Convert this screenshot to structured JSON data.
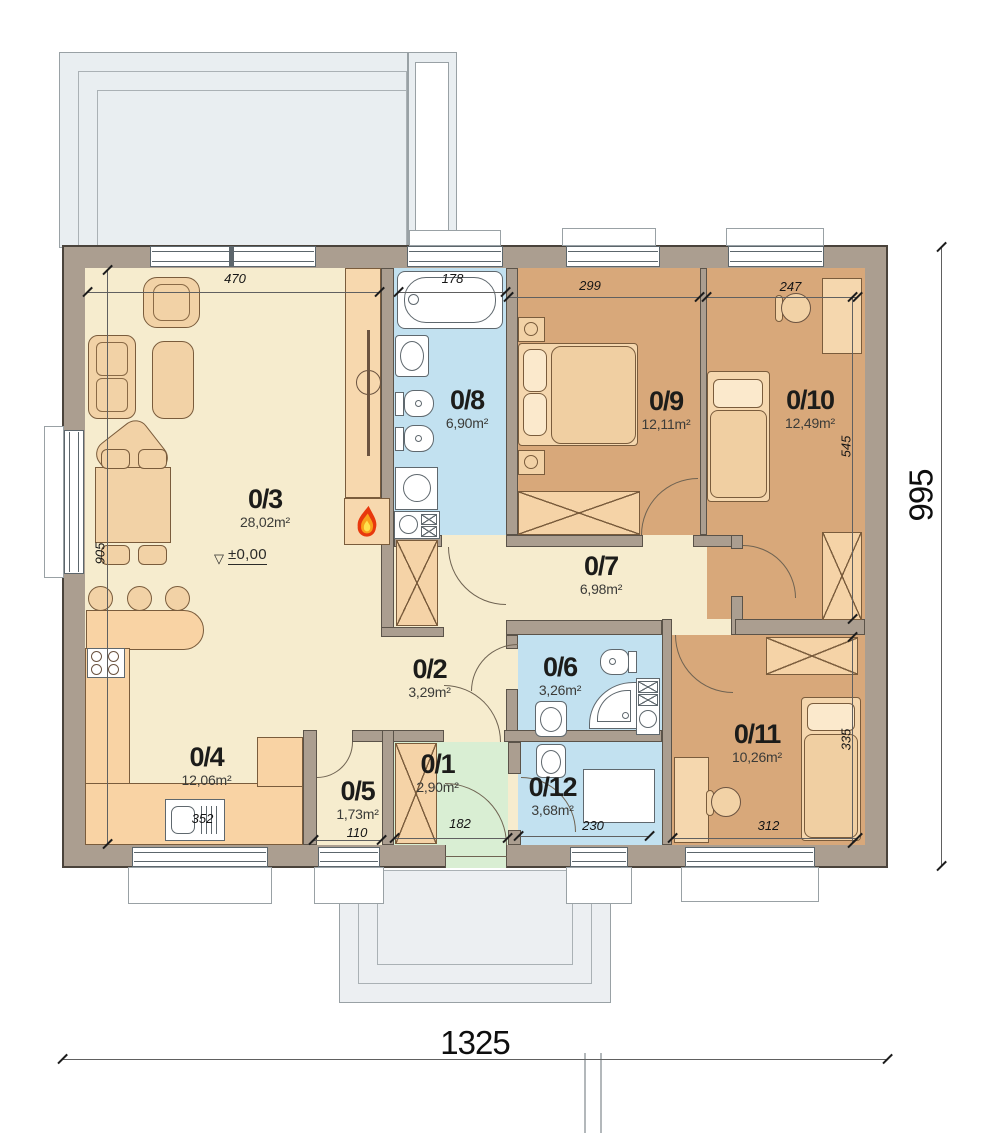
{
  "rooms": {
    "r1": {
      "num": "0/1",
      "area": "2,90m²"
    },
    "r2": {
      "num": "0/2",
      "area": "3,29m²"
    },
    "r3": {
      "num": "0/3",
      "area": "28,02m²"
    },
    "r4": {
      "num": "0/4",
      "area": "12,06m²"
    },
    "r5": {
      "num": "0/5",
      "area": "1,73m²"
    },
    "r6": {
      "num": "0/6",
      "area": "3,26m²"
    },
    "r7": {
      "num": "0/7",
      "area": "6,98m²"
    },
    "r8": {
      "num": "0/8",
      "area": "6,90m²"
    },
    "r9": {
      "num": "0/9",
      "area": "12,11m²"
    },
    "r10": {
      "num": "0/10",
      "area": "12,49m²"
    },
    "r11": {
      "num": "0/11",
      "area": "10,26m²"
    },
    "r12": {
      "num": "0/12",
      "area": "3,68m²"
    }
  },
  "dims": {
    "total_width": "1325",
    "total_depth": "995",
    "living_width": "470",
    "tub_width": "178",
    "bedroom9_width": "299",
    "bedroom10_width": "247",
    "living_depth": "905",
    "bedroom10_depth": "545",
    "bedroom11_depth": "335",
    "kitchen_counter": "352",
    "storage_width": "110",
    "entry_width": "182",
    "room12_width": "230",
    "bedroom11_width": "312",
    "level": "±0,00"
  },
  "colors": {
    "wall": "#ab9e90",
    "living": "#f6ecce",
    "bedroom": "#d8a87a",
    "bath": "#c2e1f0",
    "entry": "#d9eed3",
    "furniture": "#f2d2a6",
    "terrace": "#e9eef1",
    "flame_red": "#e8380d",
    "flame_orange": "#f9a01b",
    "flame_yellow": "#ffe14d"
  }
}
